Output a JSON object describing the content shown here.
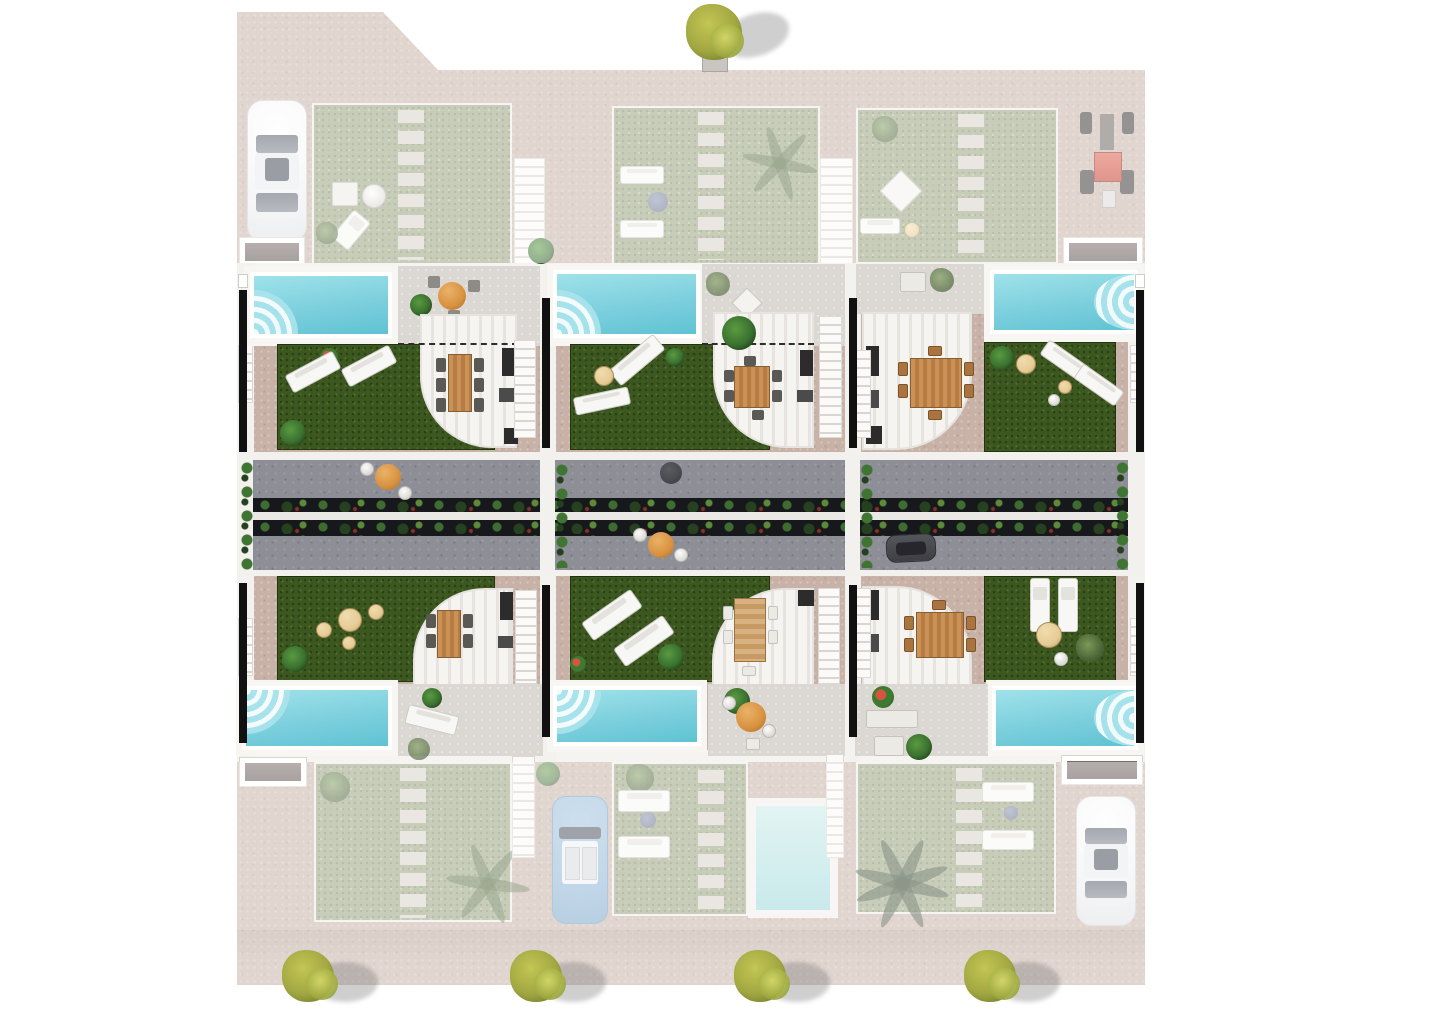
{
  "scene": {
    "type": "architectural-site-plan",
    "description": "Aerial top-down 3D render of a residential development: two facing rows of three villas, each with private pool, lawn, covered pergola dining terrace and staircase; a central landscaped street strip; perimeter paving with parked vehicles and ornamental trees.",
    "villas_count": 6,
    "bright_pools_count": 6,
    "faded_pools_count": 1,
    "street_tables_count": 3,
    "trees_count": 5
  },
  "labels": {
    "site": "Development plot paving",
    "villa": "Villa unit",
    "pool": "Private swimming pool",
    "pool_steps": "Curved pool steps",
    "garden": "Private lawn garden",
    "pergola": "Covered pergola terrace",
    "dining_table": "Outdoor dining table with chairs",
    "lounger": "Sun lounger",
    "patio": "Paved patio",
    "stairs": "Staircase",
    "stones": "Stepping-stone path",
    "street": "Central street / terrace strip",
    "planter": "Linear planter with shrubs",
    "bistro_table": "Round bistro table with chairs",
    "car_white": "White car (parked)",
    "car_blue": "Blue convertible (parked)",
    "car_dark": "Dark grey car (parked)",
    "tractor": "Red quad / tractor",
    "tree": "Ornamental tree",
    "palm": "Palm tree",
    "porch": "Entrance porch",
    "pouf": "Round pouf",
    "plant": "Ornamental plant",
    "wall": "Party wall"
  },
  "palette": {
    "bg": "#ffffff",
    "paving": "#c8b2a7",
    "grass-bright": "#3c571f",
    "grass-faded": "#99a37e",
    "pool-light": "#9fe2ea",
    "pool": "#7ccfdd",
    "pool-deep": "#5fc3d2",
    "deck": "#f7f6f3",
    "patio": "#dbd8d4",
    "pergola": "#f5f4f1",
    "pergola-stripe": "#e7e4e0",
    "stair": "#d9d5d0",
    "stone": "#d9d2cc",
    "road": "#8e8e96",
    "planter": "#17181b",
    "plant": "#3a7130",
    "tan": "#e6cb95",
    "orange": "#d8913f",
    "black-wall": "#111111",
    "tree": "#a2a742"
  }
}
